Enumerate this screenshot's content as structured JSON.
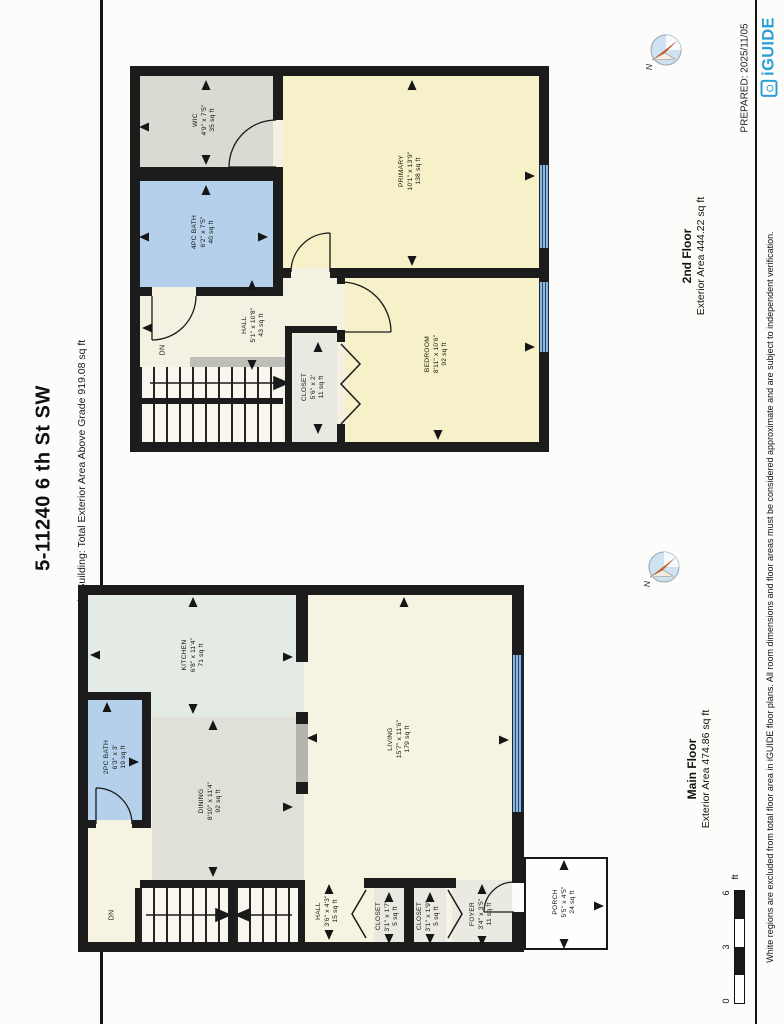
{
  "header": {
    "address": "5-11240 6 th St SW",
    "building_note": "Main Building: Total Exterior Area Above Grade 919.08 sq ft"
  },
  "meta": {
    "prepared": "PREPARED: 2025/11/05",
    "brand": "iGUIDE",
    "disclaimer": "White regions are excluded from total floor area in iGUIDE floor plans. All room dimensions and floor areas must be considered approximate and are subject to independent verification.",
    "compass_north": "N"
  },
  "floors": [
    {
      "name": "2nd Floor",
      "area_label": "Exterior Area 444.22 sq ft",
      "rooms": [
        {
          "name": "WIC",
          "dims": "4'9\" x 7'5\"",
          "area": "35 sq ft"
        },
        {
          "name": "4PC BATH",
          "dims": "6'2\" x 7'5\"",
          "area": "40 sq ft"
        },
        {
          "name": "PRIMARY",
          "dims": "10'1\" x 13'9\"",
          "area": "138 sq ft"
        },
        {
          "name": "BEDROOM",
          "dims": "8'11\" x 10'6\"",
          "area": "92 sq ft"
        },
        {
          "name": "HALL",
          "dims": "5'1\" x 10'8\"",
          "area": "43 sq ft"
        },
        {
          "name": "CLOSET",
          "dims": "5'6\" x 2'",
          "area": "11 sq ft"
        }
      ]
    },
    {
      "name": "Main Floor",
      "area_label": "Exterior Area 474.86 sq ft",
      "rooms": [
        {
          "name": "KITCHEN",
          "dims": "6'8\" x 11'4\"",
          "area": "71 sq ft"
        },
        {
          "name": "2PC BATH",
          "dims": "6'3\" x 3'",
          "area": "19 sq ft"
        },
        {
          "name": "DINING",
          "dims": "8'10\" x 11'4\"",
          "area": "92 sq ft"
        },
        {
          "name": "LIVING",
          "dims": "15'7\" x 11'6\"",
          "area": "179 sq ft"
        },
        {
          "name": "HALL",
          "dims": "3'6\" x 4'3\"",
          "area": "15 sq ft"
        },
        {
          "name": "CLOSET",
          "dims": "3'1\" x 1'7\"",
          "area": "5 sq ft"
        },
        {
          "name": "CLOSET",
          "dims": "3'1\" x 1'9\"",
          "area": "5 sq ft"
        },
        {
          "name": "FOYER",
          "dims": "3'4\" x 3'5\"",
          "area": "11 sq ft"
        },
        {
          "name": "PORCH",
          "dims": "5'5\" x 4'5\"",
          "area": "24 sq ft"
        }
      ]
    }
  ],
  "stairs": {
    "up": "UP",
    "down": "DN"
  },
  "scale_bar": {
    "ticks": [
      "0",
      "3",
      "6"
    ],
    "unit": "ft"
  },
  "colors": {
    "accent_blue": "#2d9fd6",
    "room_yellow": "#f6f1c8",
    "room_blue": "#b4d0ea",
    "room_gray": "#dadad3",
    "window_blue": "#8cb8de",
    "wall": "#1c1c1c"
  }
}
